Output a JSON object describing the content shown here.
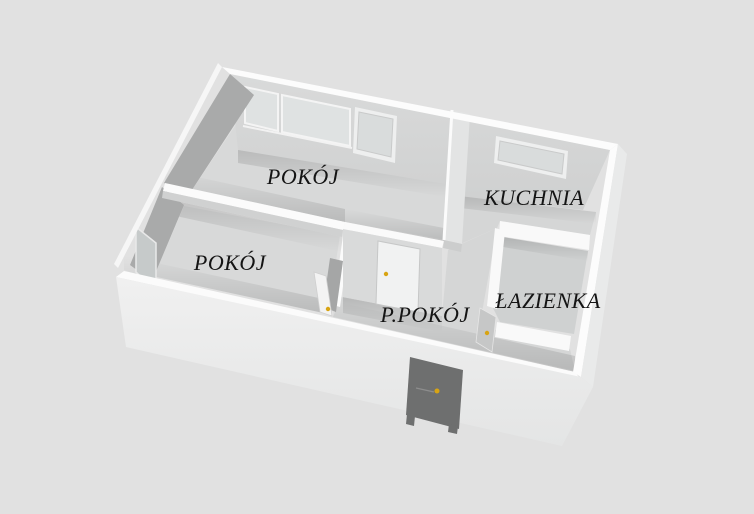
{
  "scene": {
    "type": "3d-floor-plan-render",
    "description": "Aerial 3D view of an apartment floor plan on a plain gray background"
  },
  "rooms": [
    {
      "label": "POKÓJ",
      "role": "large-room"
    },
    {
      "label": "POKÓJ",
      "role": "small-room"
    },
    {
      "label": "KUCHNIA",
      "role": "kitchen"
    },
    {
      "label": "P.POKÓJ",
      "role": "hallway"
    },
    {
      "label": "ŁAZIENKA",
      "role": "bathroom"
    }
  ],
  "features": {
    "windows": [
      "large-room-window-left",
      "large-room-window-center",
      "large-room-window-right",
      "kitchen-window",
      "small-room-window"
    ],
    "doors": [
      "entrance-door",
      "large-room-interior-door",
      "small-room-interior-door",
      "bathroom-door"
    ]
  },
  "colors": {
    "background": "#e1e1e1",
    "floor": "#d7d8d8",
    "wall_top": "#fbfbfb",
    "wall_face_light": "#d6d7d7",
    "wall_face_dark": "#a9aaaa",
    "exterior_wall": "#ebecec",
    "entrance_door": "#6e6f6f",
    "door_handle": "#d8a413",
    "window_pane": "#dfe2e2",
    "label_text": "#141414"
  }
}
